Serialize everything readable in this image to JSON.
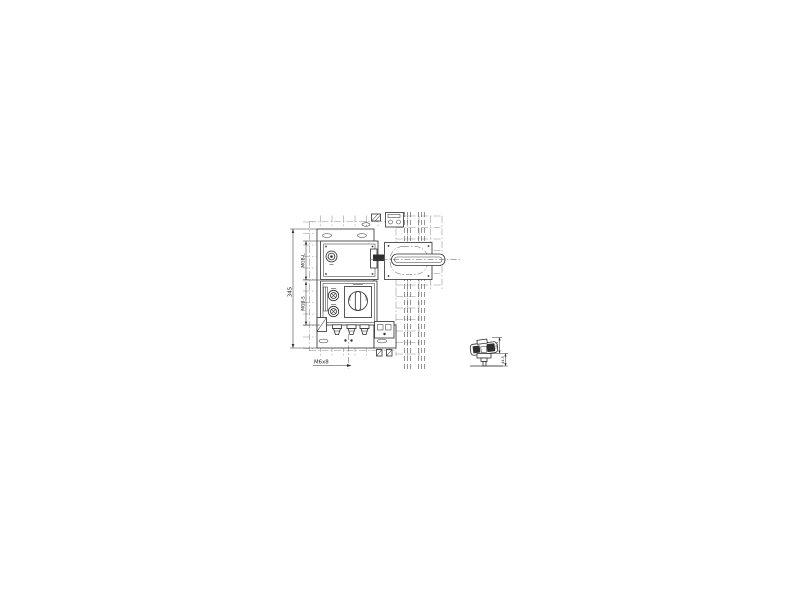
{
  "drawing": {
    "dimensions": {
      "overall_height": "345",
      "upper_module": "MGB-L",
      "lower_module": "MGB-S",
      "mounting_screw": "M6x8",
      "detail_dim_upper": "25.1",
      "detail_dim_lower": "44.5"
    },
    "colors": {
      "background": "#ffffff",
      "main_line": "#2e2e2e",
      "mesh_line": "#8f8f8f",
      "rail_line": "#4f4f4f",
      "dimension_line": "#333333"
    }
  }
}
